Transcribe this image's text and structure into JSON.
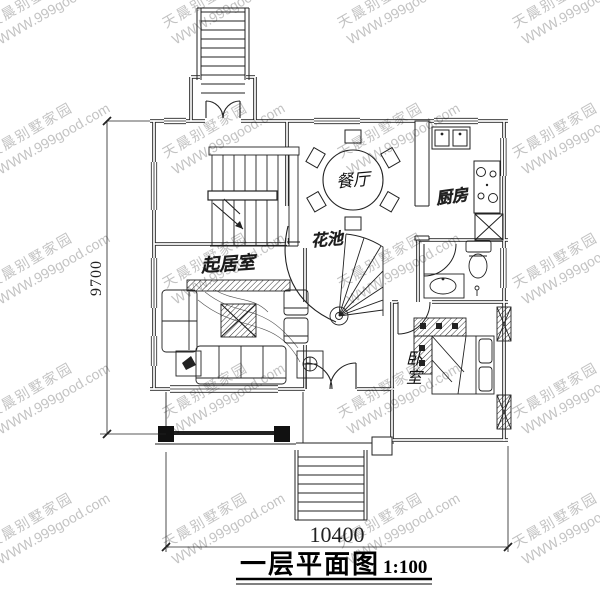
{
  "title": {
    "text": "一层平面图",
    "scale": "1:100"
  },
  "dimensions": {
    "height_mm": "9700",
    "width_mm": "10400"
  },
  "rooms": {
    "dining": {
      "label": "餐厅"
    },
    "kitchen": {
      "label": "厨房"
    },
    "flower_bed": {
      "label": "花池"
    },
    "living": {
      "label": "起居室"
    },
    "bedroom": {
      "label": "卧室"
    }
  },
  "watermark": {
    "line1": "天晨别墅家园",
    "line2": "WWW.999good.com"
  },
  "colors": {
    "line": "#222222",
    "watermark": "#c3c3c3",
    "background": "#ffffff"
  }
}
